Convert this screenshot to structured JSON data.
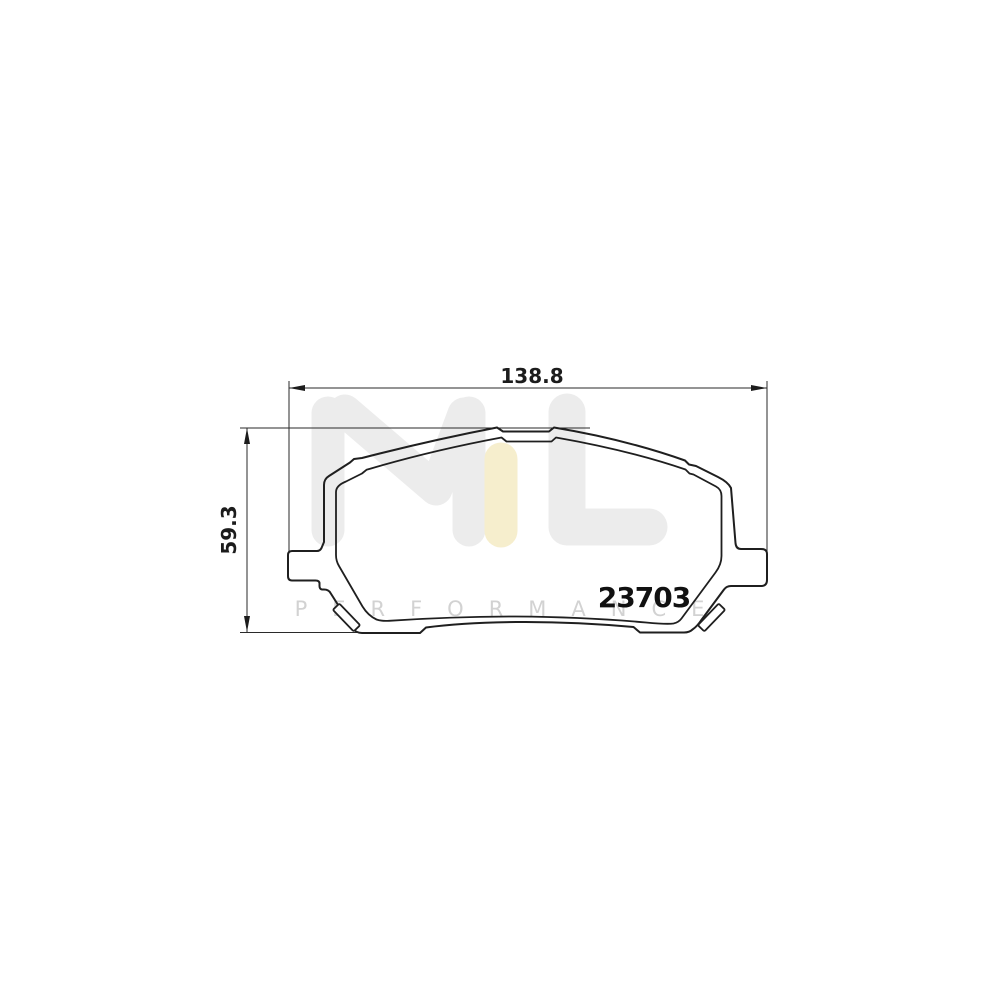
{
  "drawing": {
    "part_number": "23703",
    "dimensions": {
      "width_label": "138.8",
      "height_label": "59.3"
    },
    "watermark": {
      "letters": "ML",
      "subtext": "PERFORMANCE",
      "gray_color": "#ececec",
      "accent_color": "#f6eecd",
      "subtext_color": "#d2d2d2"
    },
    "colors": {
      "background": "#ffffff",
      "outline": "#1f1f1f",
      "dimension": "#2a2a2a"
    }
  }
}
